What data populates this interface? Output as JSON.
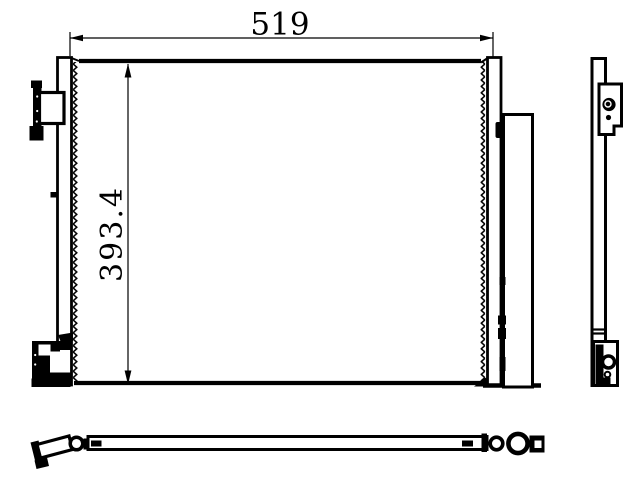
{
  "drawing": {
    "background_color": "#ffffff",
    "ink_color": "#000000",
    "dimension_labels": {
      "width": "519",
      "height": "393.4"
    }
  }
}
